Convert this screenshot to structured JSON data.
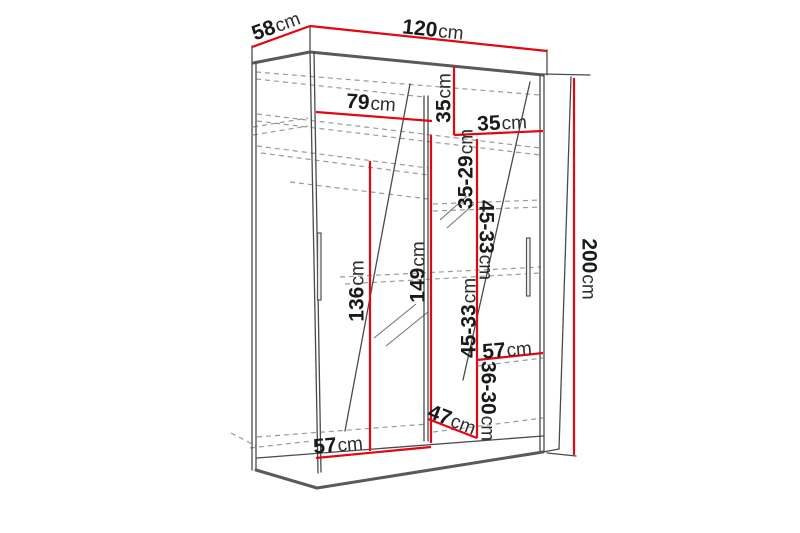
{
  "colors": {
    "dimension_line": "#e30613",
    "line_art": "#4a4a4a",
    "dashed_line": "#9a9a9a",
    "label_text": "#1a1a1a"
  },
  "dimensions": {
    "depth_top": {
      "value": "58",
      "unit": "cm"
    },
    "width_top": {
      "value": "120",
      "unit": "cm"
    },
    "height_right": {
      "value": "200",
      "unit": "cm"
    },
    "left_compartment_width": {
      "value": "79",
      "unit": "cm"
    },
    "top_shelf_height": {
      "value": "35",
      "unit": "cm"
    },
    "right_compartment_width": {
      "value": "35",
      "unit": "cm"
    },
    "shelf_spacing_1": {
      "value": "35-29",
      "unit": "cm"
    },
    "shelf_spacing_2": {
      "value": "45-33",
      "unit": "cm"
    },
    "shelf_spacing_3": {
      "value": "45-33",
      "unit": "cm"
    },
    "shelf_spacing_4": {
      "value": "36-30",
      "unit": "cm"
    },
    "hanging_space_height": {
      "value": "136",
      "unit": "cm"
    },
    "mirror_section_height": {
      "value": "149",
      "unit": "cm"
    },
    "bottom_right_width": {
      "value": "57",
      "unit": "cm"
    },
    "bottom_left_width": {
      "value": "57",
      "unit": "cm"
    },
    "bottom_depth": {
      "value": "47",
      "unit": "cm"
    }
  }
}
